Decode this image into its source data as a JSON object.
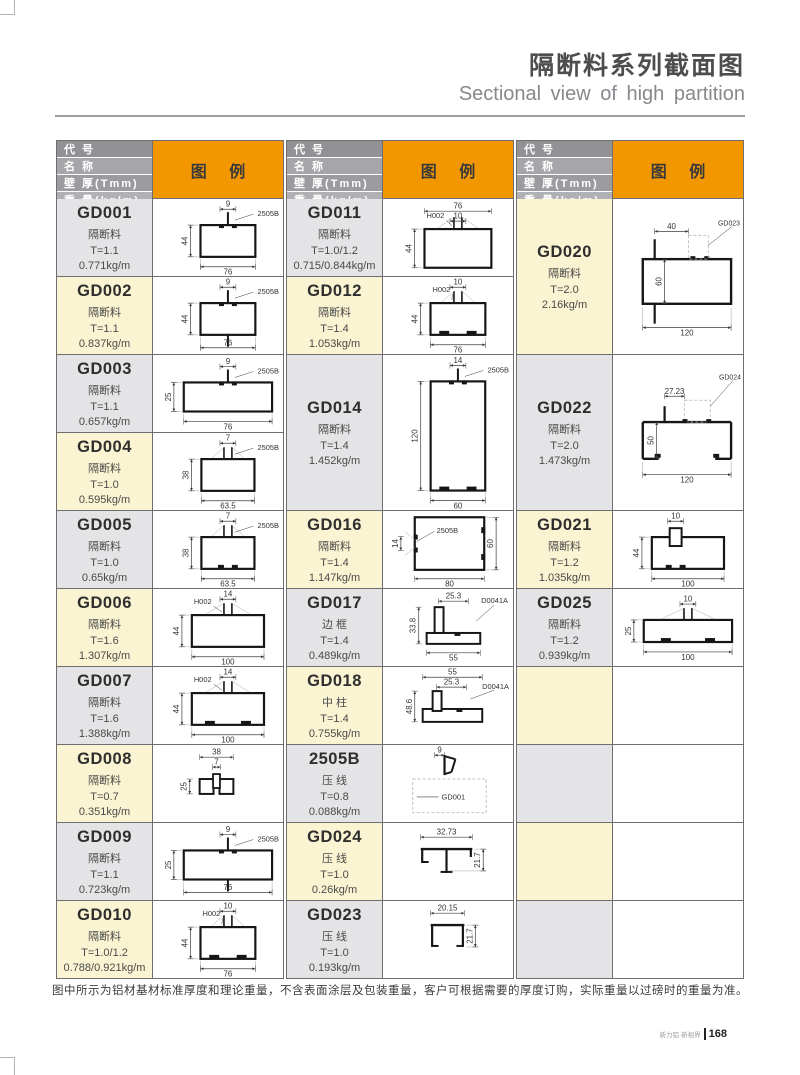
{
  "page": {
    "title_cn": "隔断料系列截面图",
    "title_en": "Sectional view of high partition",
    "footer_note": "图中所示为铝材基材标准厚度和理论重量，不含表面涂层及包装重量，客户可根据需要的厚度订购，实际重量以过磅时的重量为准。",
    "footer_brand": "新力铝·新视界",
    "footer_page": "168"
  },
  "header_labels": [
    "代 号",
    "名 称",
    "壁 厚(Tmm)",
    "重 量(kg/m)"
  ],
  "legend_label": "图 例",
  "colors": {
    "orange": "#F39700",
    "row_gray": "#E4E4E6",
    "row_cream": "#FBF4D2",
    "grid": "#6e6e70",
    "header_bgs": [
      "#929296",
      "#a6a6aa",
      "#9c9ca0",
      "#b1b1b5"
    ]
  },
  "columns": [
    {
      "rows": [
        {
          "code": "GD001",
          "name": "隔断料",
          "t": "T=1.1",
          "wt": "0.771kg/m",
          "tone": "gray",
          "span": 1,
          "d": {
            "kind": "box",
            "w": 76,
            "h": 44,
            "dl": "44",
            "db": "76",
            "dt": "9",
            "ref": "2505B",
            "refSide": "tr",
            "top": "stem",
            "notchTop": true
          }
        },
        {
          "code": "GD002",
          "name": "隔断料",
          "t": "T=1.1",
          "wt": "0.837kg/m",
          "tone": "cream",
          "span": 1,
          "d": {
            "kind": "box",
            "w": 76,
            "h": 44,
            "dl": "44",
            "db": "76",
            "dt": "9",
            "ref": "2505B",
            "refSide": "tr",
            "top": "stem",
            "notchTop": true,
            "stemBottom": true
          }
        },
        {
          "code": "GD003",
          "name": "隔断料",
          "t": "T=1.1",
          "wt": "0.657kg/m",
          "tone": "gray",
          "span": 1,
          "d": {
            "kind": "box",
            "w": 76,
            "h": 25,
            "dl": "25",
            "db": "76",
            "dt": "9",
            "ref": "2505B",
            "refSide": "tr",
            "top": "stem",
            "notchTop": true
          }
        },
        {
          "code": "GD004",
          "name": "隔断料",
          "t": "T=1.0",
          "wt": "0.595kg/m",
          "tone": "cream",
          "span": 1,
          "d": {
            "kind": "box",
            "w": 63.5,
            "h": 38,
            "dl": "38",
            "db": "63.5",
            "dt": "7",
            "ref": "2505B",
            "refSide": "tr",
            "top": "funnel"
          }
        },
        {
          "code": "GD005",
          "name": "隔断料",
          "t": "T=1.0",
          "wt": "0.65kg/m",
          "tone": "gray",
          "span": 1,
          "d": {
            "kind": "box",
            "w": 63.5,
            "h": 38,
            "dl": "38",
            "db": "63.5",
            "dt": "7",
            "ref": "2505B",
            "refSide": "tr",
            "top": "funnel",
            "notchB": true
          }
        },
        {
          "code": "GD006",
          "name": "隔断料",
          "t": "T=1.6",
          "wt": "1.307kg/m",
          "tone": "cream",
          "span": 1,
          "d": {
            "kind": "box",
            "w": 100,
            "h": 44,
            "dl": "44",
            "db": "100",
            "dt": "14",
            "ref": "H002",
            "refSide": "tl",
            "top": "funnel"
          }
        },
        {
          "code": "GD007",
          "name": "隔断料",
          "t": "T=1.6",
          "wt": "1.388kg/m",
          "tone": "gray",
          "span": 1,
          "d": {
            "kind": "box",
            "w": 100,
            "h": 44,
            "dl": "44",
            "db": "100",
            "dt": "14",
            "ref": "H002",
            "refSide": "tl",
            "top": "funnel",
            "notchesB": true
          }
        },
        {
          "code": "GD008",
          "name": "隔断料",
          "t": "T=0.7",
          "wt": "0.351kg/m",
          "tone": "cream",
          "span": 1,
          "d": {
            "kind": "tee",
            "dtf": "38",
            "dt": "7",
            "dl": "25"
          }
        },
        {
          "code": "GD009",
          "name": "隔断料",
          "t": "T=1.1",
          "wt": "0.723kg/m",
          "tone": "gray",
          "span": 1,
          "d": {
            "kind": "box",
            "w": 76,
            "h": 25,
            "dl": "25",
            "db": "76",
            "dt": "9",
            "ref": "2505B",
            "refSide": "tr",
            "top": "stem",
            "notchTop": true,
            "stemBottom": true
          }
        },
        {
          "code": "GD010",
          "name": "隔断料",
          "t": "T=1.0/1.2",
          "wt": "0.788/0.921kg/m",
          "tone": "cream",
          "span": 1,
          "d": {
            "kind": "box",
            "w": 76,
            "h": 44,
            "dl": "44",
            "db": "76",
            "dt": "10",
            "ref": "H002",
            "refSide": "tl",
            "top": "funnel",
            "notchesB": true
          }
        }
      ]
    },
    {
      "rows": [
        {
          "code": "GD011",
          "name": "隔断料",
          "t": "T=1.0/1.2",
          "wt": "0.715/0.844kg/m",
          "tone": "gray",
          "span": 1,
          "d": {
            "kind": "box",
            "w": 76,
            "h": 44,
            "dl": "44",
            "dtf": "76",
            "dt": "10",
            "ref": "H002",
            "refSide": "tl",
            "top": "funnel"
          }
        },
        {
          "code": "GD012",
          "name": "隔断料",
          "t": "T=1.4",
          "wt": "1.053kg/m",
          "tone": "cream",
          "span": 1,
          "d": {
            "kind": "box",
            "w": 76,
            "h": 44,
            "dl": "44",
            "db": "76",
            "dt": "10",
            "ref": "H002",
            "refSide": "tl",
            "top": "funnel",
            "notchesB": true
          }
        },
        {
          "code": "GD014",
          "name": "隔断料",
          "t": "T=1.4",
          "wt": "1.452kg/m",
          "tone": "gray",
          "span": 2,
          "d": {
            "kind": "box",
            "w": 60,
            "h": 120,
            "dl": "120",
            "db": "60",
            "dt": "14",
            "ref": "2505B",
            "refSide": "tr",
            "top": "stem",
            "notchTop": true,
            "notchesB": true
          }
        },
        {
          "code": "GD016",
          "name": "隔断料",
          "t": "T=1.4",
          "wt": "1.147kg/m",
          "tone": "cream",
          "span": 1,
          "d": {
            "kind": "sidebox",
            "w": 80,
            "h": 60,
            "dr": "60",
            "db": "80",
            "ds": "14",
            "ref": "2505B"
          }
        },
        {
          "code": "GD017",
          "name": "边 框",
          "t": "T=1.4",
          "wt": "0.489kg/m",
          "tone": "gray",
          "span": 1,
          "d": {
            "kind": "frame17",
            "dt": "25.3",
            "dl": "33.8",
            "db": "55",
            "ref": "D0041A"
          }
        },
        {
          "code": "GD018",
          "name": "中 柱",
          "t": "T=1.4",
          "wt": "0.755kg/m",
          "tone": "cream",
          "span": 1,
          "d": {
            "kind": "frame18",
            "dtf": "55",
            "dt": "25.3",
            "dl": "48.6",
            "ref": "D0041A"
          }
        },
        {
          "code": "2505B",
          "name": "压 线",
          "t": "T=0.8",
          "wt": "0.088kg/m",
          "tone": "gray",
          "span": 1,
          "d": {
            "kind": "clip",
            "dt": "9",
            "ref": "GD001"
          }
        },
        {
          "code": "GD024",
          "name": "压 线",
          "t": "T=1.0",
          "wt": "0.26kg/m",
          "tone": "cream",
          "span": 1,
          "d": {
            "kind": "channel",
            "dt": "32.73",
            "dr": "21.7",
            "wide": true
          }
        },
        {
          "code": "GD023",
          "name": "压 线",
          "t": "T=1.0",
          "wt": "0.193kg/m",
          "tone": "gray",
          "span": 1,
          "d": {
            "kind": "channel",
            "dt": "20.15",
            "dr": "21.7",
            "wide": false
          }
        }
      ]
    },
    {
      "rows": [
        {
          "code": "GD020",
          "name": "隔断料",
          "t": "T=2.0",
          "wt": "2.16kg/m",
          "tone": "cream",
          "span": 2,
          "d": {
            "kind": "panel",
            "variant": 20,
            "dl": "60",
            "db": "120",
            "dt": "40",
            "ref": "GD023"
          }
        },
        {
          "code": "GD022",
          "name": "隔断料",
          "t": "T=2.0",
          "wt": "1.473kg/m",
          "tone": "gray",
          "span": 2,
          "d": {
            "kind": "panel",
            "variant": 22,
            "dl": "50",
            "db": "120",
            "dt": "27.23",
            "ref": "GD024"
          }
        },
        {
          "code": "GD021",
          "name": "隔断料",
          "t": "T=1.2",
          "wt": "1.035kg/m",
          "tone": "cream",
          "span": 1,
          "d": {
            "kind": "box",
            "w": 100,
            "h": 44,
            "dl": "44",
            "db": "100",
            "dt": "10",
            "top": "tab",
            "notchB": true
          }
        },
        {
          "code": "GD025",
          "name": "隔断料",
          "t": "T=1.2",
          "wt": "0.939kg/m",
          "tone": "gray",
          "span": 1,
          "d": {
            "kind": "box",
            "w": 100,
            "h": 25,
            "dl": "25",
            "db": "100",
            "dt": "10",
            "top": "funnel",
            "notchesB": true
          }
        },
        {
          "code": "",
          "tone": "cream",
          "span": 1,
          "d": null
        },
        {
          "code": "",
          "tone": "gray",
          "span": 1,
          "d": null
        },
        {
          "code": "",
          "tone": "cream",
          "span": 1,
          "d": null
        },
        {
          "code": "",
          "tone": "gray",
          "span": 1,
          "d": null
        }
      ]
    }
  ]
}
